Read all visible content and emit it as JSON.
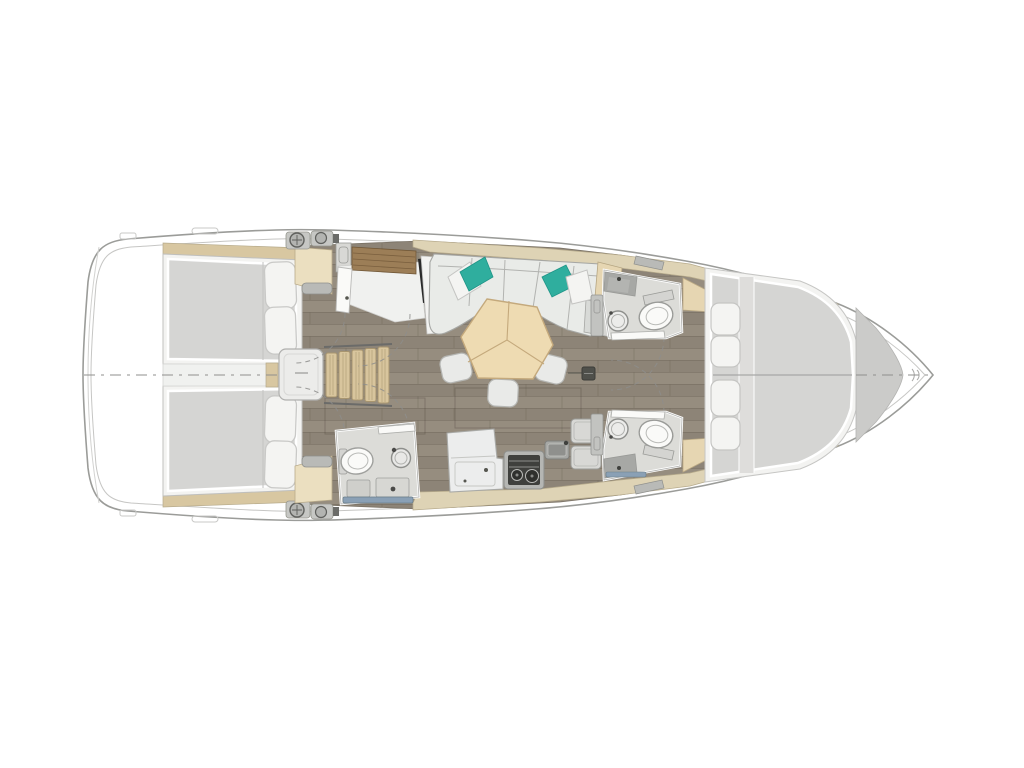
{
  "description": "Sailboat interior layout floor plan, top-down view, bow pointing right",
  "colors": {
    "background": "#ffffff",
    "hull_line": "#9b9c99",
    "hull_inner": "#c6c6c4",
    "deck_tan": "#ded3b5",
    "trim_wood": "#d8c7a1",
    "step_wood": "#d8c59d",
    "shelf_wood": "#9c7e57",
    "floor_wood": "#8d8477",
    "floor_wood_alt": "#968d7f",
    "floor_seam": "#6e6557",
    "corridor_light": "#f0f1ef",
    "engine_box": "#ececea",
    "bed_platform": "#f3f3f1",
    "mattress": "#d5d5d3",
    "mattress_strip": "#dedddb",
    "pillow_white": "#f4f4f2",
    "pillow_teal": "#2fae9e",
    "settee": "#e9ebe8",
    "settee_shadow": "#d8dad7",
    "table_wood": "#eedbb2",
    "table_seam": "#c4a97c",
    "stool": "#e9eae8",
    "counter_white": "#eceded",
    "cabinet_gray": "#d8d8d5",
    "stove_frame": "#b5b6b3",
    "stove_body": "#3f403d",
    "sink_gray": "#a7a8a5",
    "head_floor": "#dcdcd8",
    "fixture_white": "#fafaf8",
    "fixture_line": "#9a9b98",
    "shower_rail": "#8aa0b5",
    "wardrobe_beige": "#ebdfc0",
    "bench_beige": "#e6d6b2",
    "forepeak_gray": "#cbcbc9",
    "hardware_gray": "#c6c7c4",
    "door_gray": "#c2c3c0",
    "tv_black": "#2b2b2b",
    "centerline": "#8f8f8d",
    "hatch_gray": "#b9bab7"
  },
  "areas": [
    {
      "id": "stern-platform",
      "label": "stern platform"
    },
    {
      "id": "aft-cabin-port",
      "label": "aft double cabin (top)"
    },
    {
      "id": "aft-cabin-starboard",
      "label": "aft double cabin (bottom)"
    },
    {
      "id": "aft-corridor",
      "label": "corridor between aft cabins"
    },
    {
      "id": "engine-box",
      "label": "engine compartment"
    },
    {
      "id": "companionway-steps",
      "label": "companionway ladder"
    },
    {
      "id": "nav-shelf",
      "label": "wood shelf / nav area"
    },
    {
      "id": "tv-panel",
      "label": "flat screen panel"
    },
    {
      "id": "aft-head",
      "label": "aft bathroom with toilet, sink, shower"
    },
    {
      "id": "salon-settee",
      "label": "U-shaped settee with pillows"
    },
    {
      "id": "salon-table",
      "label": "hexagonal wood table"
    },
    {
      "id": "stools",
      "label": "three stools"
    },
    {
      "id": "galley",
      "label": "galley with stove, sink, cabinets"
    },
    {
      "id": "fwd-head-port",
      "label": "forward bathroom (top)"
    },
    {
      "id": "fwd-head-starboard",
      "label": "forward bathroom (bottom)"
    },
    {
      "id": "fwd-cabin",
      "label": "forward V-berth cabin"
    },
    {
      "id": "forepeak",
      "label": "forepeak locker"
    },
    {
      "id": "deck-winches",
      "label": "deck winches"
    },
    {
      "id": "mast-foot",
      "label": "mast foot fitting"
    }
  ]
}
